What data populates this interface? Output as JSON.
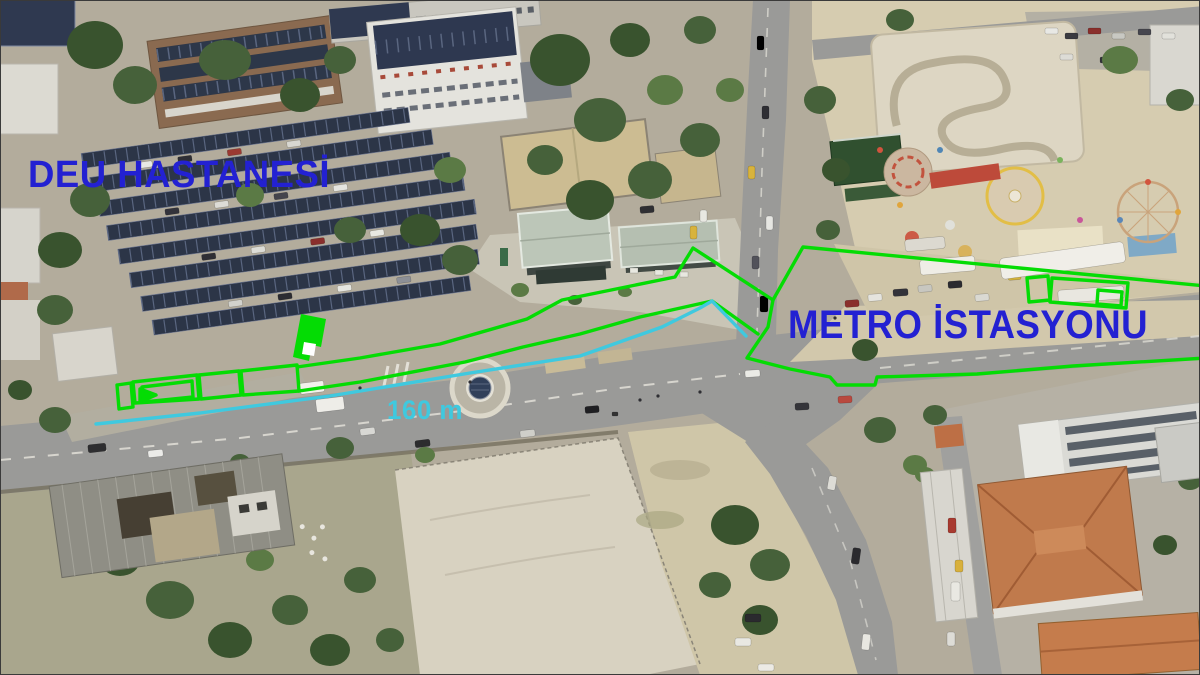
{
  "labels": {
    "hospital": {
      "text": "DEU HASTANESİ",
      "color": "#2321d2"
    },
    "metro": {
      "text": "METRO İSTASYONU",
      "color": "#2321d2"
    },
    "distance": {
      "text": "160 m",
      "color": "#3fc9df"
    }
  },
  "annotations": {
    "outline_color": "#04dc04",
    "measure_color": "#3fc9df",
    "regions": [
      "bus-stop-boxes",
      "walkway-outline",
      "station-entrance-marker",
      "metro-station-boundary",
      "bus-bay-boxes",
      "distance-measure-line"
    ]
  }
}
